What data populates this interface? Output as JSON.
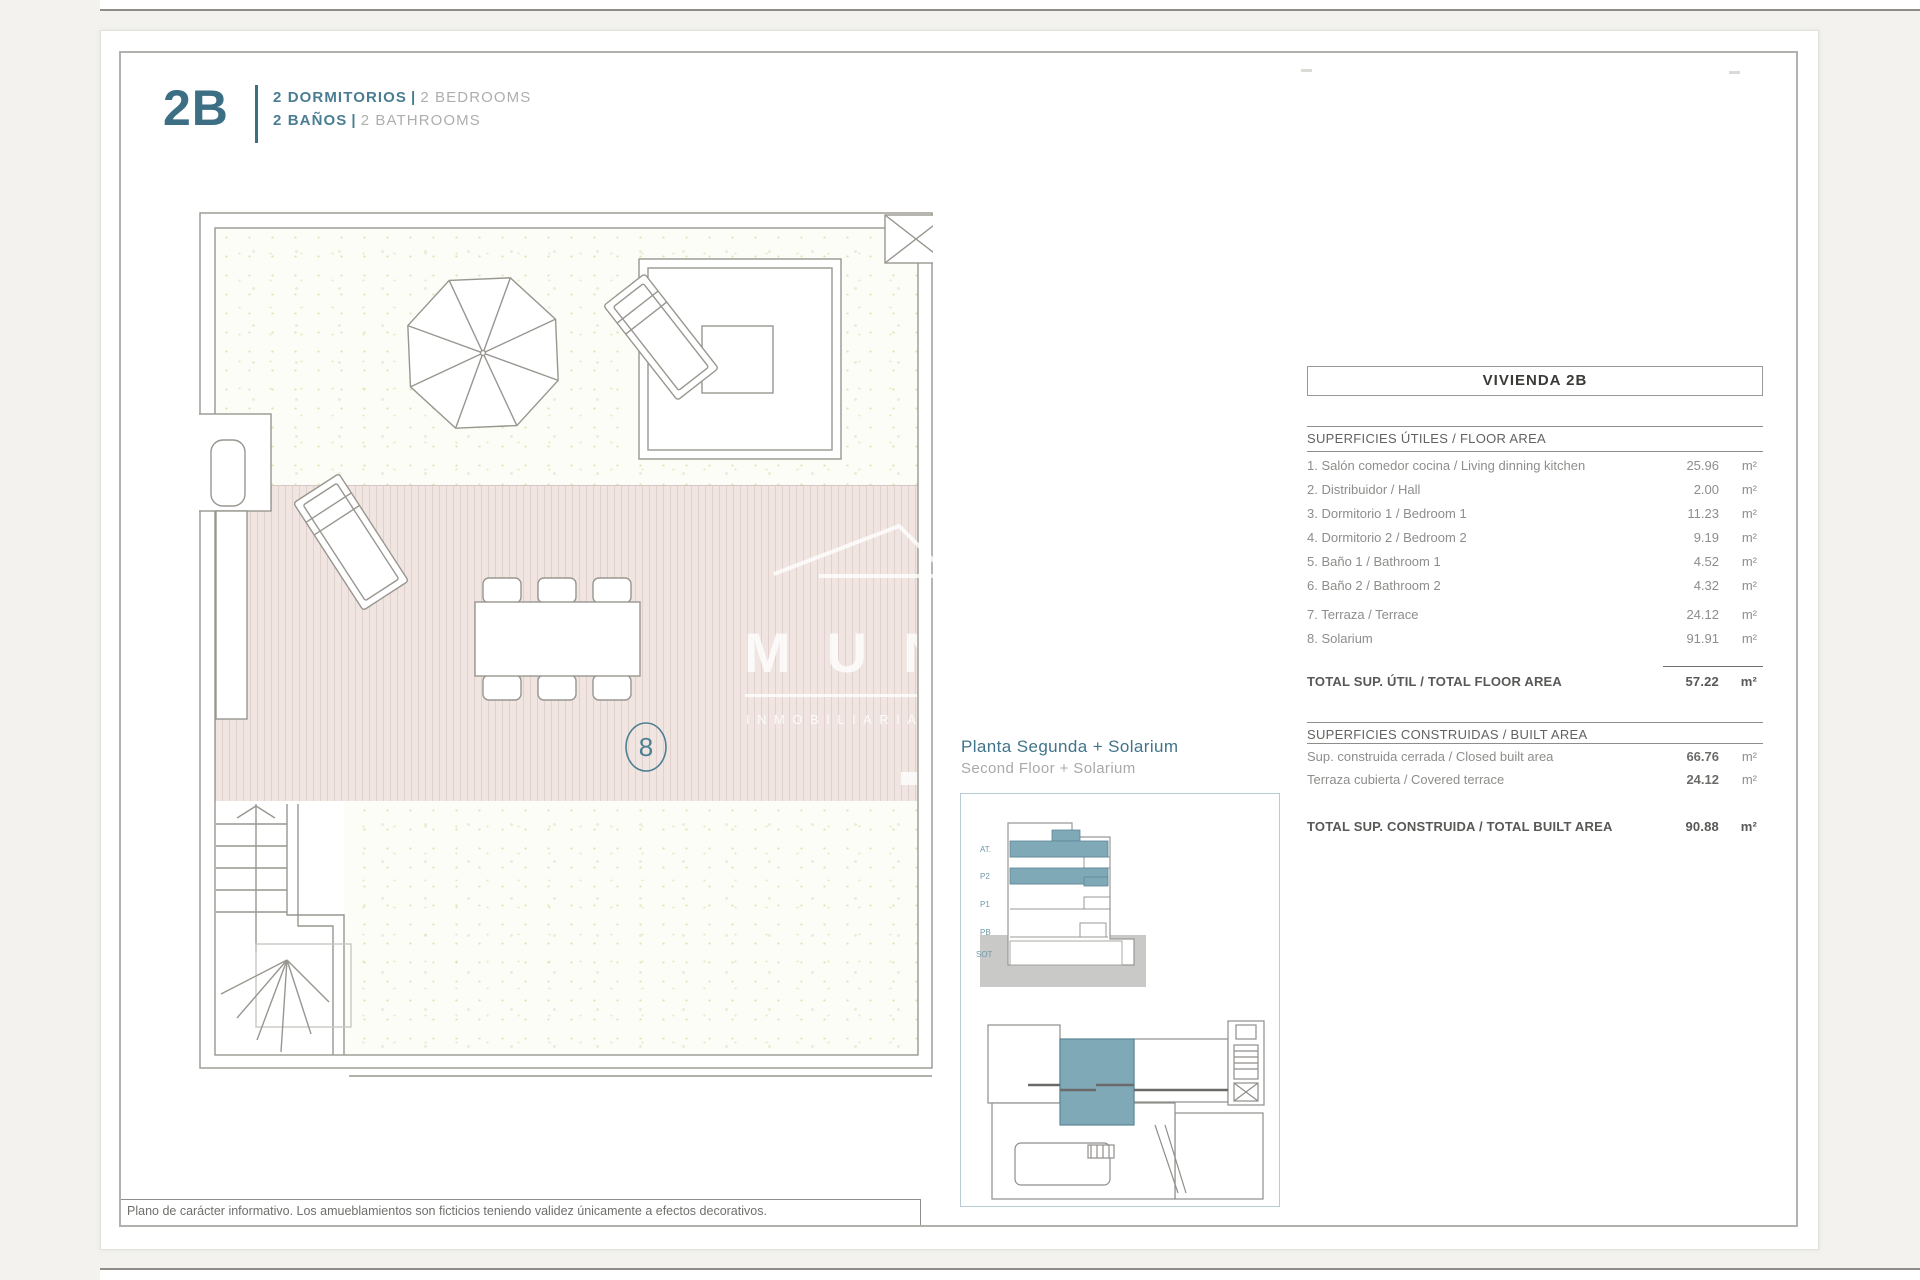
{
  "header": {
    "unit_code": "2B",
    "separator": "|",
    "line1": {
      "primary": "2 DORMITORIOS",
      "secondary": "2 BEDROOMS"
    },
    "line2": {
      "primary": "2 BAÑOS",
      "secondary": "2 BATHROOMS"
    }
  },
  "plan": {
    "room_number": "8",
    "watermark": {
      "letters": "MUN",
      "subtitle": "INMOBILIARIA"
    }
  },
  "floor_label": {
    "es": "Planta Segunda + Solarium",
    "en": "Second Floor + Solarium"
  },
  "inset": {
    "levels": [
      "AT.",
      "P2",
      "P1",
      "PB",
      "SOT"
    ]
  },
  "table": {
    "title": "VIVIENDA 2B",
    "floor_section": "SUPERFICIES ÚTILES / FLOOR AREA",
    "floor_rows": [
      {
        "label": "1. Salón comedor cocina / Living dinning kitchen",
        "value": "25.96",
        "unit": "m²"
      },
      {
        "label": "2. Distribuidor / Hall",
        "value": "2.00",
        "unit": "m²"
      },
      {
        "label": "3. Dormitorio 1 / Bedroom 1",
        "value": "11.23",
        "unit": "m²"
      },
      {
        "label": "4. Dormitorio 2 / Bedroom 2",
        "value": "9.19",
        "unit": "m²"
      },
      {
        "label": "5. Baño 1 / Bathroom 1",
        "value": "4.52",
        "unit": "m²"
      },
      {
        "label": "6. Baño 2 / Bathroom 2",
        "value": "4.32",
        "unit": "m²"
      }
    ],
    "extra_rows": [
      {
        "label": "7. Terraza / Terrace",
        "value": "24.12",
        "unit": "m²"
      },
      {
        "label": "8. Solarium",
        "value": "91.91",
        "unit": "m²"
      }
    ],
    "floor_total": {
      "label": "TOTAL SUP. ÚTIL / TOTAL FLOOR AREA",
      "value": "57.22",
      "unit": "m²"
    },
    "built_section": "SUPERFICIES CONSTRUIDAS / BUILT AREA",
    "built_rows": [
      {
        "label": "Sup. construida cerrada / Closed built area",
        "value": "66.76",
        "unit": "m²"
      },
      {
        "label": "Terraza cubierta / Covered terrace",
        "value": "24.12",
        "unit": "m²"
      }
    ],
    "built_total": {
      "label": "TOTAL SUP. CONSTRUIDA /  TOTAL BUILT AREA",
      "value": "90.88",
      "unit": "m²"
    }
  },
  "footer": {
    "disclaimer": "Plano de carácter informativo. Los amueblamientos son ficticios teniendo validez únicamente a efectos decorativos."
  },
  "colors": {
    "accent_teal": "#3c6e84",
    "label_teal": "#41748a",
    "highlight_fill": "#80a9b8",
    "line_gray": "#8f8d89",
    "text_gray": "#8d8d8b",
    "deck_pink": "#f0e5e1"
  }
}
